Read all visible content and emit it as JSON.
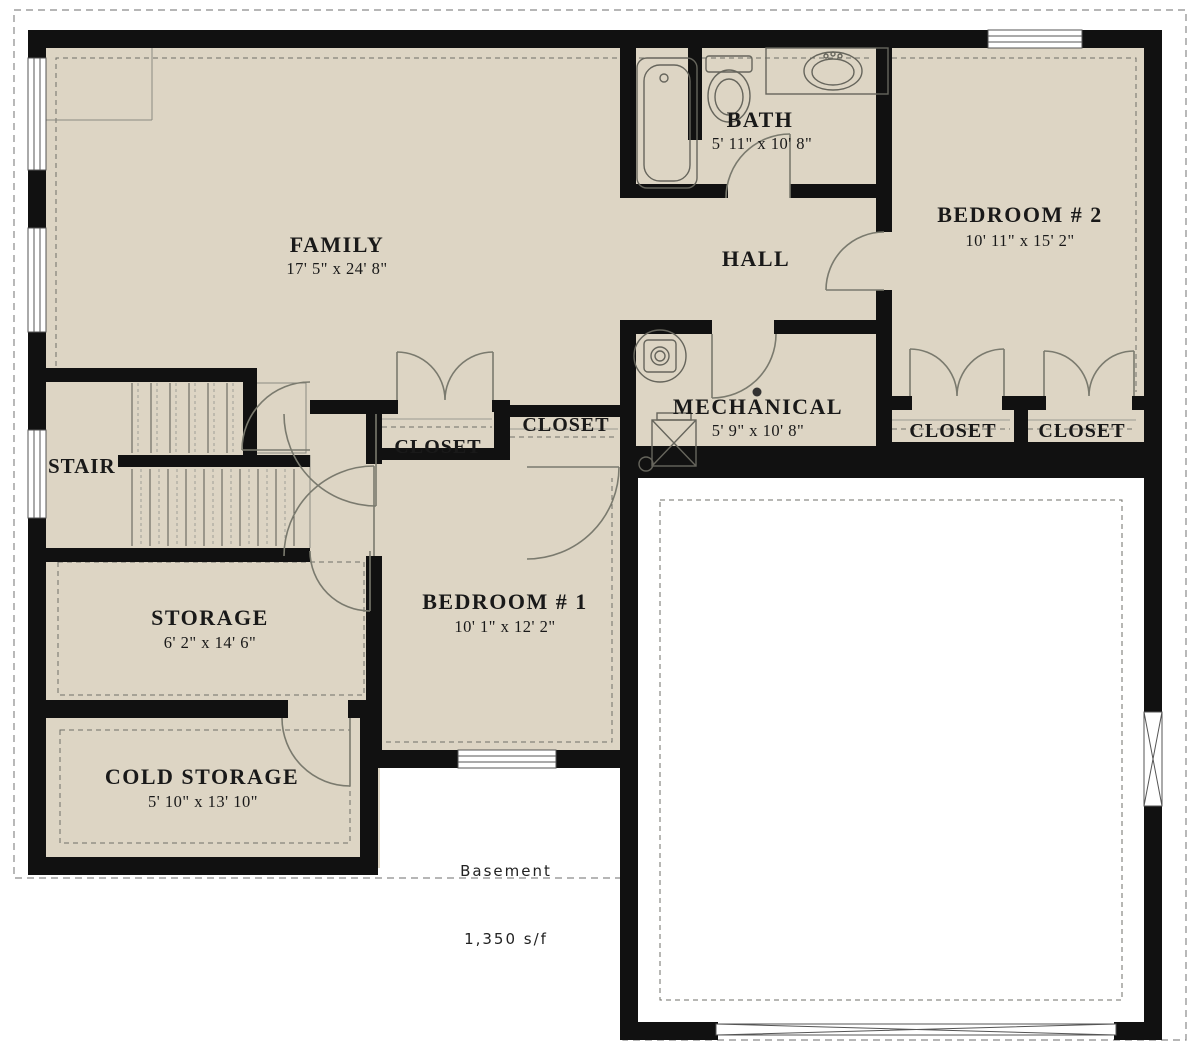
{
  "title": "Basement floor plan",
  "colors": {
    "floor": "#ddd5c4",
    "wall": "#111111",
    "background": "#ffffff",
    "line": "#7a7a6e",
    "text": "#191919"
  },
  "rooms": {
    "family": {
      "label": "FAMILY",
      "dims": "17' 5\" x 24' 8\""
    },
    "bath": {
      "label": "BATH",
      "dims": "5' 11\" x 10' 8\""
    },
    "hall": {
      "label": "HALL"
    },
    "bedroom2": {
      "label": "BEDROOM # 2",
      "dims": "10' 11\" x 15' 2\""
    },
    "mechanical": {
      "label": "MECHANICAL",
      "dims": "5' 9\" x 10' 8\""
    },
    "stair": {
      "label": "STAIR"
    },
    "storage": {
      "label": "STORAGE",
      "dims": "6' 2\" x 14' 6\""
    },
    "bedroom1": {
      "label": "BEDROOM # 1",
      "dims": "10' 1\" x 12' 2\""
    },
    "cold_storage": {
      "label": "COLD STORAGE",
      "dims": "5' 10\" x 13' 10\""
    }
  },
  "closets": {
    "labels": [
      "CLOSET",
      "CLOSET",
      "CLOSET",
      "CLOSET"
    ]
  },
  "footer": {
    "floor_name": "Basement",
    "area": "1,350 s/f"
  },
  "fixtures": {
    "bathtub": "bathtub-icon",
    "toilet": "toilet-icon",
    "sink": "sink-vanity-icon",
    "water_heater": "water-heater-icon",
    "furnace": "furnace-icon",
    "garage_door": "garage-door-icon"
  }
}
